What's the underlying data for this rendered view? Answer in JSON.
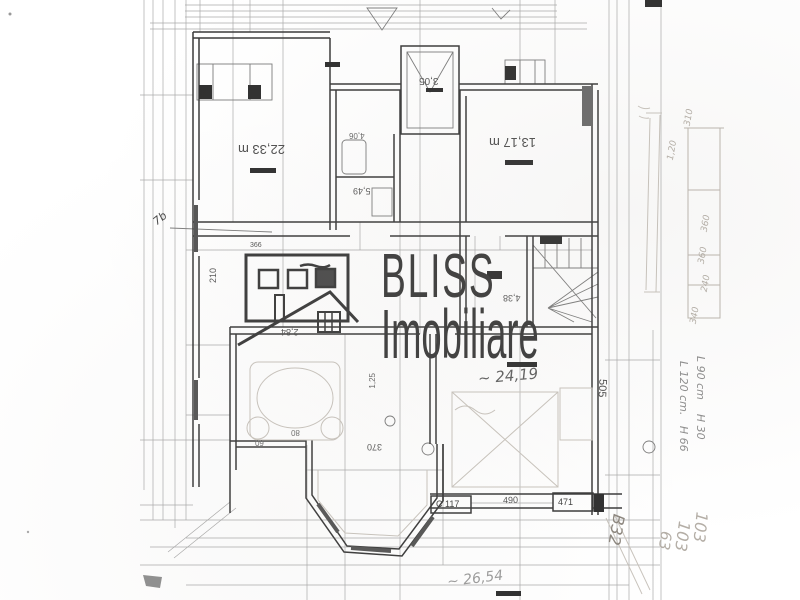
{
  "watermark": {
    "brand": "BLISS",
    "subtitle": "Imobiliare"
  },
  "room_labels": {
    "top_left": "22,33 m",
    "top_right": "13,17 m",
    "top_center": "3,05",
    "mid_a": "4,06",
    "mid_b": "5,49",
    "hall": "4,38",
    "bedroom": "~ 24,19",
    "living": "~ 26,54"
  },
  "dim_labels": {
    "d505": "505",
    "d490": "490",
    "d471": "471",
    "c117": "C 117",
    "d370": "370",
    "d210": "210",
    "d125": "1,25",
    "d284": "2,84",
    "d366": "366",
    "d80": "80",
    "d60": "60",
    "d7b": "7b"
  },
  "notes": {
    "win1": "L 90 cm    H 30",
    "win2": "L 120 cm.   H 66",
    "n103a": "103",
    "n103b": "103",
    "n63": "63",
    "b32": "B32",
    "p310": "310",
    "p120": "1,20",
    "p360a": "360",
    "p360b": "360",
    "p240": "240",
    "p340": "340"
  },
  "colors": {
    "ink": "#3a3a3a",
    "pencil": "#bcb6ae",
    "watermark": "#3a3a3a",
    "paper": "#ffffff"
  }
}
